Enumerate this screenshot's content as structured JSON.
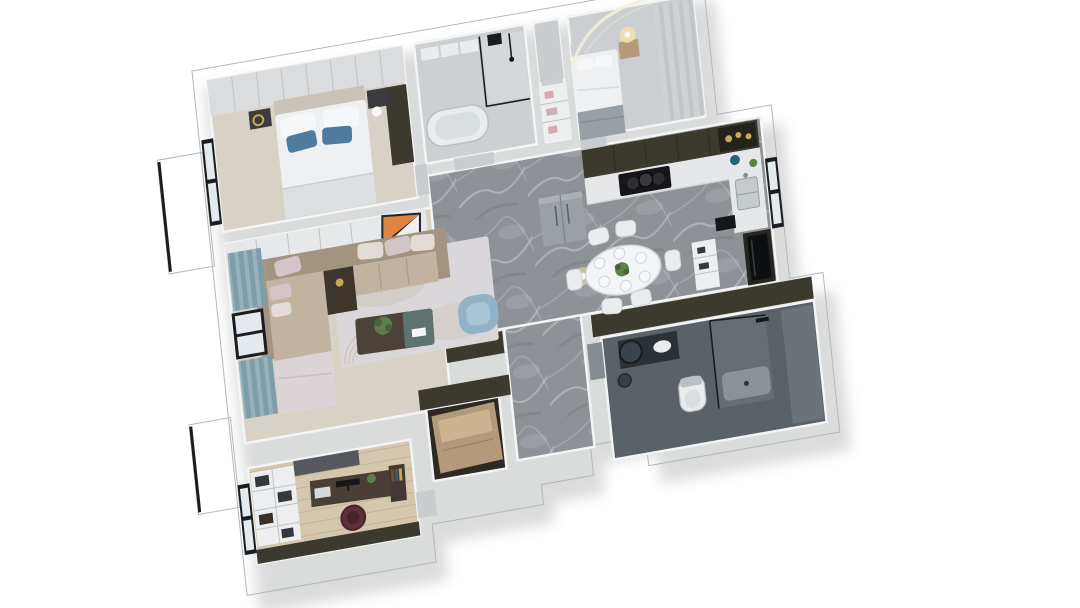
{
  "scene": {
    "title": "3D rendered apartment floor plan, top-down axonometric view",
    "view": "top-down-axonometric",
    "rotation_deg": -10,
    "background": "#ffffff"
  },
  "colors": {
    "background": "#ffffff",
    "wall": "#c7cbcd",
    "wall_edge": "#f2f4f5",
    "slab": "#c2c6c9",
    "olive": "#3c3a2e",
    "marble": "#8e9297",
    "floor_cream": "#d8d2c6",
    "floor_gray": "#ccd0d3",
    "floor_gray2": "#cbcfd2",
    "floor_wood": "#d5c6ae",
    "floor_dark": "#2e2a22",
    "floor_slate": "#5a6167",
    "rug": "#dad7db",
    "rug_patch": "#cdc5b8",
    "rug_fan": "#c9ab72",
    "sofa_back": "#a3947f",
    "sofa_seat": "#c2b3a0",
    "lounge_blush": "#dcd3d7",
    "pillow_blush": "#d2c5c8",
    "pillow_sand": "#e3dcd5",
    "side_table": "#3e362d",
    "coffee_dark": "#4b4239",
    "coffee_teal": "#5e7370",
    "armchair": "#92b2c8",
    "armchair_inner": "#a9c4d4",
    "curtain_a": "#7e9dab",
    "curtain_b": "#97b2bd",
    "panel_a": "#ced2d5",
    "panel_b": "#c2c6c9",
    "plant": "#5d7d4b",
    "plant_dark": "#47633a",
    "bed_white": "#eef0f2",
    "bed_fold": "#dde0e2",
    "pillow_white": "#f6f7f8",
    "pillow_blue": "#4e7ca0",
    "headboard": "#c9c2b8",
    "headboard2": "#cdd0d2",
    "blanket_gray": "#989fa5",
    "nightstand": "#3b3b3e",
    "wood_cab": "#b39a7a",
    "wood_cab_top": "#ccb491",
    "wardrobe": "#dadcdd",
    "seam": "#c0c3c5",
    "counter": "#e5e7e8",
    "stove": "#16161a",
    "fridge": "#9aa0a5",
    "steel": "#c5cacd",
    "window_frame": "#1b1c1f",
    "window_glass": "#e3e9ec",
    "glow": "#f6dfa8",
    "led": "#f4eeda",
    "table_white": "#f3f4f5",
    "chair_white": "#eaedee",
    "line_gray": "#d2d6d8",
    "pantry": "#26261f",
    "glass_dark": "#0d0e10",
    "vanity": "#2c3136",
    "mirror": "#3a434b",
    "fixture": "#e9ebed",
    "fix_shadow": "#b9bfc3",
    "desk": "#4a3f35",
    "maroon": "#5d3238",
    "maroon_dark": "#46262b",
    "shelf": "#eceef0",
    "item_dark": "#34373b",
    "door_gray": "#c9cdd0",
    "door_dark": "#868d92",
    "gold": "#c9a55e",
    "teal_accent": "#2e5e76",
    "gray_cab": "#55585c",
    "tub_inner": "#d9dee1",
    "shadow": "#2a2e33"
  },
  "rooms": [
    {
      "name": "master-bedroom",
      "items": [
        "wardrobe",
        "double-bed",
        "white-pillows",
        "blue-pillows",
        "nightstands",
        "floor-lamp",
        "gold-pendant",
        "tall-dark-cabinet",
        "window"
      ]
    },
    {
      "name": "bathroom-1",
      "items": [
        "glass-shower",
        "shower-set",
        "bathtub",
        "wall-cabinet",
        "storage-boxes",
        "door"
      ]
    },
    {
      "name": "hall-closet",
      "items": [
        "door",
        "open-shelf",
        "pink-decor"
      ]
    },
    {
      "name": "bedroom-2",
      "items": [
        "double-bed",
        "gray-throw",
        "nightstand",
        "table-lamp",
        "led-cove-arc",
        "panel-wall"
      ]
    },
    {
      "name": "kitchen",
      "items": [
        "upper-cabinets",
        "brass-decor-niche",
        "counter",
        "cooktop",
        "pot",
        "sink",
        "window",
        "kettle",
        "refrigerator",
        "open-shelf",
        "pantry-glass-cabinet",
        "coffee-machine"
      ]
    },
    {
      "name": "dining-area",
      "items": [
        "dining-table",
        "six-chairs",
        "six-plates",
        "centerpiece-plant",
        "pendant-light"
      ]
    },
    {
      "name": "hallway",
      "items": [
        "marble-floor"
      ]
    },
    {
      "name": "living-room",
      "items": [
        "tv-cabinet",
        "orange-artwork",
        "l-shaped-sofa",
        "throw-pillows",
        "corner-side-table",
        "coffee-table",
        "plant",
        "blue-armchair",
        "area-rug",
        "curtains",
        "window"
      ]
    },
    {
      "name": "study",
      "items": [
        "bookshelf",
        "low-cabinet",
        "desk",
        "monitor",
        "laptop",
        "books",
        "office-chair",
        "window"
      ]
    },
    {
      "name": "entry-closet",
      "items": [
        "wood-cabinet"
      ]
    },
    {
      "name": "bathroom-2",
      "items": [
        "vanity",
        "round-mirror",
        "sink",
        "stool",
        "toilet",
        "glass-shower",
        "shower-head",
        "shower-tray",
        "door"
      ]
    },
    {
      "name": "balcony",
      "items": [
        "balcony-slab-upper",
        "balcony-slab-lower",
        "glass-balustrade"
      ]
    }
  ]
}
